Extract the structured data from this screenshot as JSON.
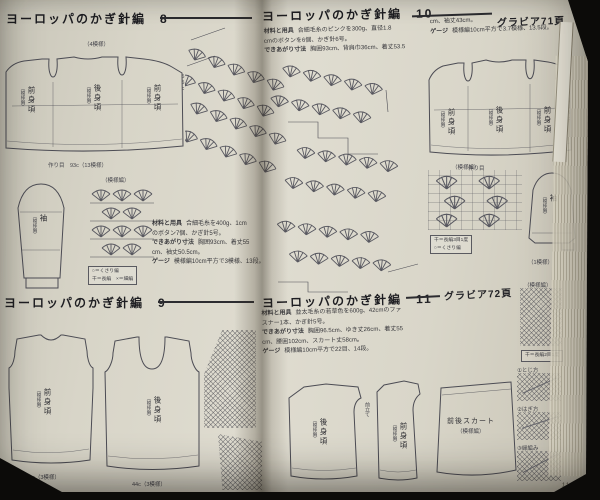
{
  "series_title": "ヨーロッパのかぎ針編",
  "page": {
    "number": "113"
  },
  "sections": {
    "s8": {
      "num": "8"
    },
    "s9": {
      "num": "9"
    },
    "s10": {
      "num": "10",
      "gravure": "グラビア71頁"
    },
    "s11": {
      "num": "11",
      "gravure": "グラビア72頁"
    }
  },
  "labels": {
    "front": "前身頃",
    "back": "後身頃",
    "sleeve": "袖",
    "pattern_note": "（模様編）",
    "skirt": "前後スカート"
  },
  "spec8": {
    "materials_label": "材料と用具",
    "materials_1": "合細毛糸を400g、1cm",
    "materials_2": "のボタン7個、かぎ針5号。",
    "finished_label": "できあがり寸法",
    "finished_1": "胸囲93cm、着丈55",
    "finished_2": "cm、袖丈50.5cm。",
    "gauge_label": "ゲージ",
    "gauge": "模様編10cm平方で3模様、13段。"
  },
  "spec10": {
    "materials_label": "材料と用具",
    "materials_1": "合細毛糸のピンクを300g、直径1.8",
    "materials_2": "cmのボタンを6個、かぎ針6号。",
    "finished_label": "できあがり寸法",
    "finished_1": "胸囲93cm、背肩巾36cm、着丈53.5",
    "finished_2": "cm、袖丈43cm。",
    "gauge_label": "ゲージ",
    "gauge": "模様編10cm平方で3.7模様、13.5段。"
  },
  "spec11": {
    "materials_label": "材料と用具",
    "materials_1": "並太毛糸の若草色を600g、42cmのファ",
    "materials_2": "スナー1本、かぎ針5号。",
    "finished_label": "できあがり寸法",
    "finished_1": "胸囲96.5cm、ゆき丈26cm、着丈55",
    "finished_2": "cm、腰囲102cm、スカート丈58cm。",
    "gauge_label": "ゲージ",
    "gauge": "模様編10cm平方で22目、14段。"
  },
  "legend1": {
    "row1": "○＝くさり編",
    "row2": "干＝長編　×＝細編"
  },
  "legend2": {
    "row1": "干＝長編3目1度",
    "row2": "○＝くさり編"
  },
  "legend3": {
    "row1": "干＝長編2目1度"
  },
  "ann": {
    "top_motifs": "（4模様）",
    "bottom8": "作り目　93c（13模様）",
    "len8": "55c",
    "width9a": "44c（3模様）",
    "width9b": "44c（3模様）",
    "cast10": "作り目",
    "len10": "53.5c",
    "motif1": "（1模様）",
    "placket": "前立て"
  },
  "illus": {
    "c1": "①とじ方",
    "c2": "②はぎ方",
    "c3": "③縁編み"
  }
}
